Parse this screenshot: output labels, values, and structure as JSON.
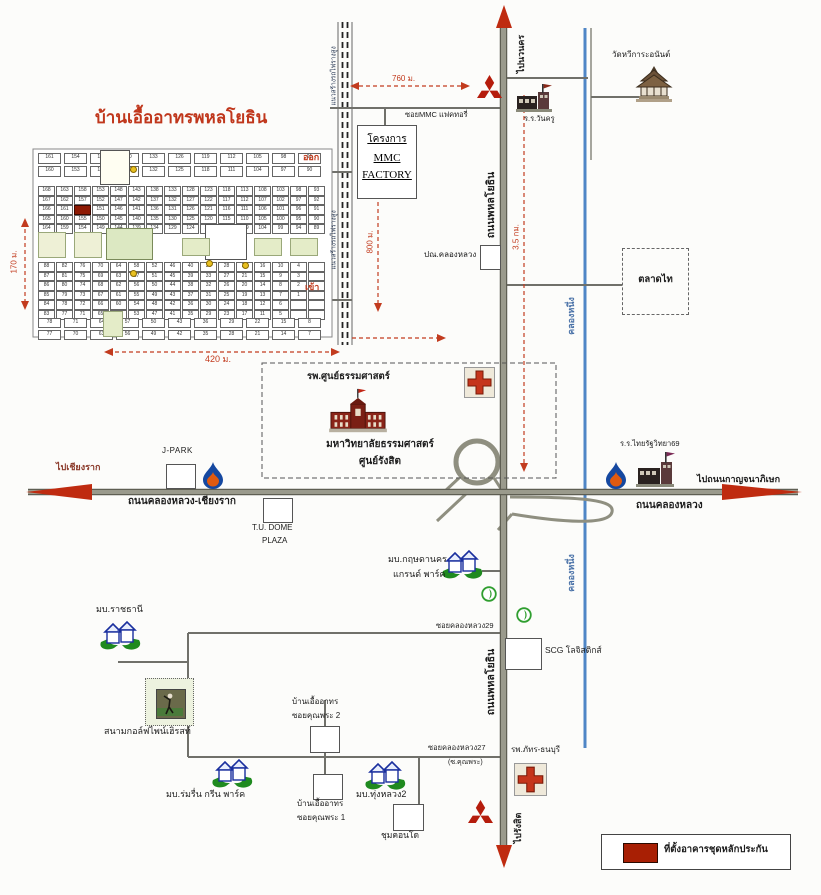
{
  "colors": {
    "road": "#9a9a8c",
    "road_edge": "#5e5e52",
    "minor_road": "#70706a",
    "canal": "#4f86c6",
    "accent_red": "#c23b1e",
    "arrow_red": "#bf2b10",
    "estate_title": "#c0371c",
    "legend_swatch": "#a81f04",
    "green_block": "#dce8c2"
  },
  "estate": {
    "title": "บ้านเอื้ออาทรพหลโยธิน",
    "exit": "ออก",
    "entry": "เข้า",
    "width": "420 ม.",
    "height": "170 ม.",
    "grid": {
      "top_band_cols": 11,
      "col_groups": 8,
      "upper_rows": 5,
      "lower_rows": 6,
      "bottom_band_cols": 11,
      "start_number": 168
    }
  },
  "railway": {
    "label": "แนวสร้างรถไฟรางสูง"
  },
  "canal": {
    "label": "คลองหนึ่ง"
  },
  "roads": {
    "phahonyothin": "ถนนพหลโยธิน",
    "to_navanakorn": "ไปนวนคร",
    "to_rangsit": "ไปรังสิต",
    "khlongluang_chiangrak": "ถนนคลองหลวง-เชียงราก",
    "to_chiangrak": "ไปเชียงราก",
    "khlongluang": "ถนนคลองหลวง",
    "to_kanchanaphisek": "ไปถนนกาญจนาภิเษก",
    "soi_mmc": "ซอยMMC แฟคทอรี่",
    "soi_29": "ซอยคลองหลวง29",
    "soi_27": "ซอยคลองหลวง27",
    "soi_27_alt": "(ซ.คุณพระ)"
  },
  "dimensions": {
    "d760": "760 ม.",
    "d800": "800 ม.",
    "d35": "3.5 กม.",
    "d420": "420 ม.",
    "d170": "170 ม."
  },
  "places": {
    "temple": "วัดหวีการะอนันต์",
    "wankru_school": "ร.ร.วันครู",
    "mmc_line1": "โครงการ",
    "mmc_line2": "MMC",
    "mmc_line3": "FACTORY",
    "post_office": "ปณ.คลองหลวง",
    "talad_thai": "ตลาดไท",
    "tu_hospital": "รพ.ศูนย์ธรรมศาสตร์",
    "tu_univ_line1": "มหาวิทยาลัยธรรมศาสตร์",
    "tu_univ_line2": "ศูนย์รังสิต",
    "jpark": "J-PARK",
    "tu_dome_line1": "T.U. DOME",
    "tu_dome_line2": "PLAZA",
    "thairath_school": "ร.ร.ไทยรัฐวิทยา69",
    "krisda_line1": "มบ.กฤษดานคร",
    "krisda_line2": "แกรนด์ พาร์ค",
    "ratchathani": "มบ.ราชธานี",
    "scg": "SCG โลจิสติกส์",
    "golf": "สนามกอล์ฟไพน์เฮิรสท์",
    "baan_eua2_line1": "บ้านเอื้ออาทร",
    "baan_eua2_line2": "ซอยคุณพระ 2",
    "baan_eua1_line1": "บ้านเอื้ออาทร",
    "baan_eua1_line2": "ซอยคุณพระ 1",
    "romruen": "มบ.ร่มรื่น กรีน พาร์ค",
    "thungluang": "มบ.ทุ่งหลวง2",
    "chum_condo": "ชุมคอนโด",
    "phatara_hospital": "รพ.ภัทร-ธนบุรี"
  },
  "legend": {
    "label": "ที่ตั้งอาคารชุดหลักประกัน"
  },
  "icons": {
    "mitsubishi": "three-red-diamonds",
    "ptt": "blue-flame-drop",
    "bangchak": "green-leaf-circle",
    "red_cross": "hospital-cross",
    "house": "village-house",
    "temple": "thai-pavilion",
    "school": "school-building",
    "university": "dome-building",
    "golfer": "golf-photo"
  }
}
